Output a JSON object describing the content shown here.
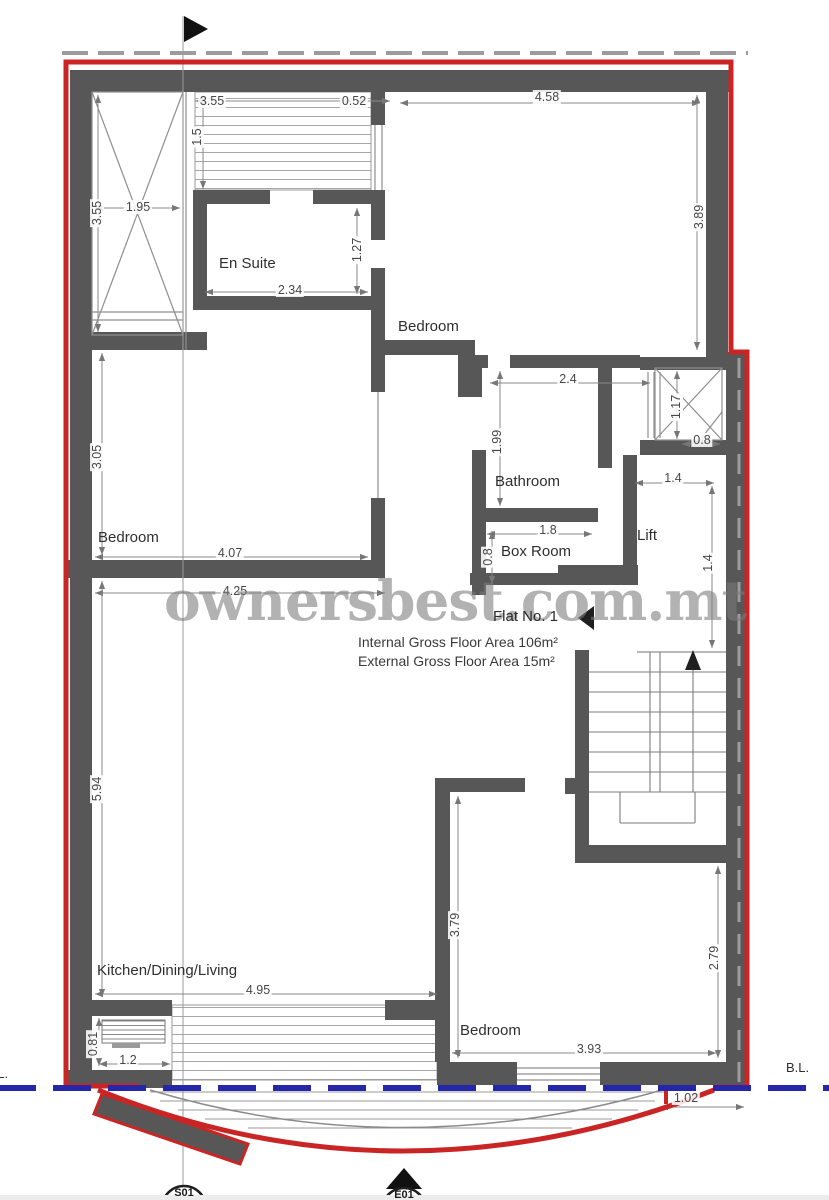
{
  "title": "Flat No. 1 floor plan",
  "watermark": "ownersbest.com.mt",
  "flat": {
    "name": "Flat No. 1",
    "internal_area": "Internal Gross Floor Area 106m²",
    "external_area": "External Gross Floor Area 15m²"
  },
  "rooms": {
    "en_suite": "En Suite",
    "bedroom_top": "Bedroom",
    "bedroom_left": "Bedroom",
    "bedroom_bottom": "Bedroom",
    "bathroom": "Bathroom",
    "box_room": "Box Room",
    "lift": "Lift",
    "kitchen": "Kitchen/Dining/Living"
  },
  "boundary": {
    "left": "B.L.",
    "right": "B.L."
  },
  "markers": {
    "section": "S01",
    "elevation": "E01"
  },
  "dimensions": {
    "terrace_width": "3.55",
    "parapet_right": "0.52",
    "bedroom_top_width": "4.58",
    "terrace_depth": "1.5",
    "bedroom_top_depth": "3.89",
    "shaft_width": "1.95",
    "shaft_depth": "3.55",
    "ensuite_opening": "1.27",
    "ensuite_width": "2.34",
    "bathroom_width": "2.4",
    "bathroom_depth": "1.99",
    "shaft2_depth": "1.17",
    "shaft2_width": "0.8",
    "lift_width": "1.4",
    "lift_depth": "1.4",
    "bedroom_left_depth": "3.05",
    "bedroom_left_width": "4.07",
    "boxroom_width": "1.8",
    "boxroom_depth": "0.8",
    "living_width": "4.25",
    "living_depth": "5.94",
    "kitchen_width": "4.95",
    "bedroom_bottom_depth_left": "3.79",
    "bedroom_bottom_depth_right": "2.79",
    "bedroom_bottom_width": "3.93",
    "planter_depth": "0.81",
    "planter_width": "1.2",
    "balcony_side_offset": "1.02"
  },
  "colors": {
    "wall": "#575757",
    "site_boundary_red": "#c92525",
    "building_line_blue": "#2626a8",
    "dim_line": "#8a8a8a"
  }
}
